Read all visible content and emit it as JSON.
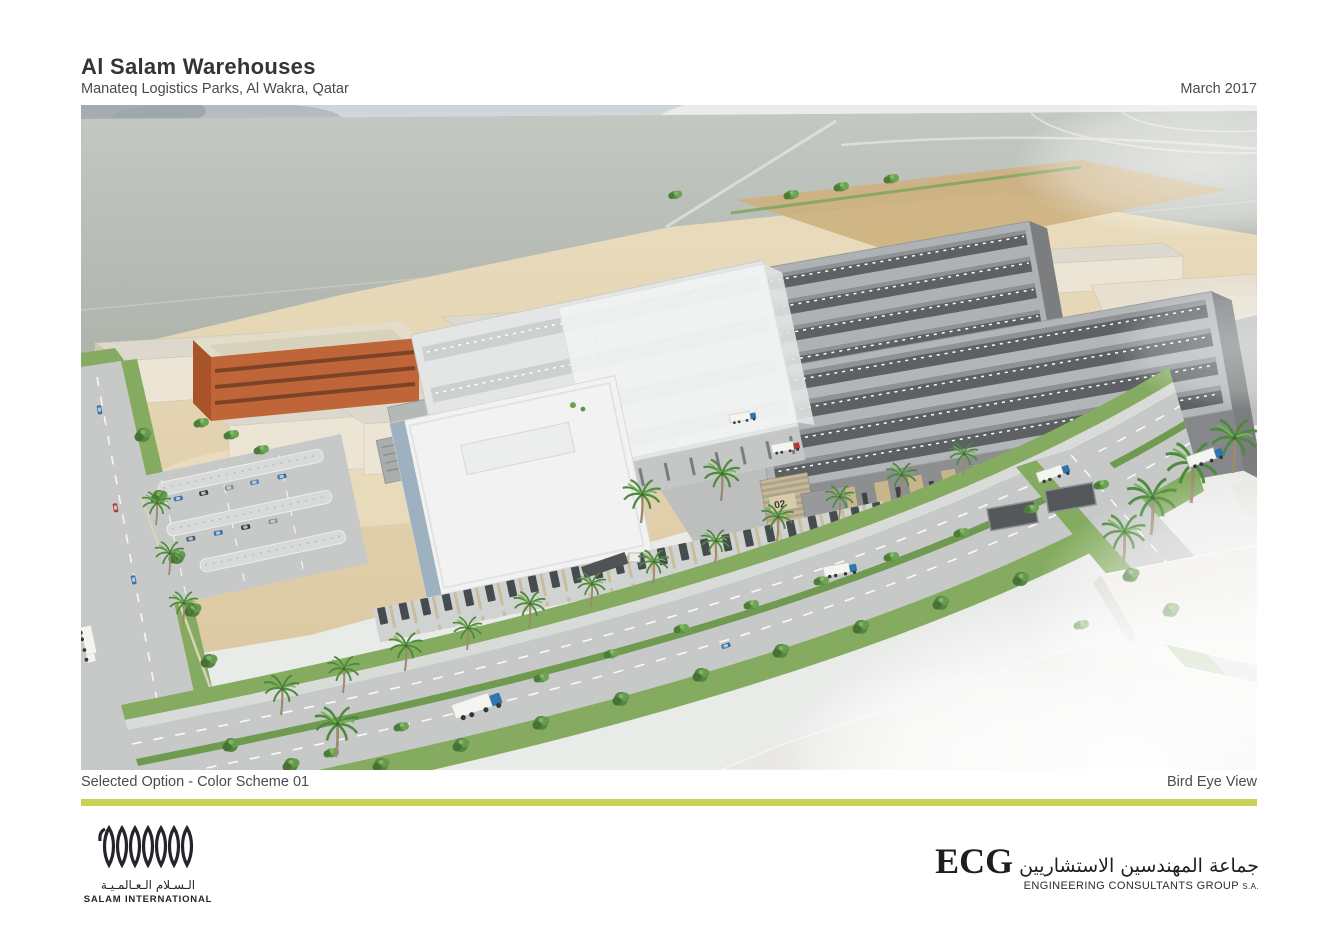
{
  "header": {
    "title": "Al Salam Warehouses",
    "subtitle": "Manateq Logistics Parks, Al Wakra, Qatar",
    "date": "March 2017"
  },
  "footer": {
    "caption_left": "Selected Option - Color Scheme 01",
    "caption_right": "Bird Eye View"
  },
  "scene": {
    "building_01_label": "01",
    "building_02_label": "02",
    "salam_wall_signature": "SALAM"
  },
  "logos": {
    "salam_international": {
      "name_arabic": "الـسـلام الـعـالمـيـة",
      "name_latin": "SALAM INTERNATIONAL"
    },
    "ecg": {
      "acronym": "ECG",
      "name_arabic": "جماعة المهندسين الاستشاريين",
      "name_latin": "ENGINEERING CONSULTANTS GROUP",
      "suffix": "S.A."
    }
  },
  "colors": {
    "accent_bar": "#c7d254",
    "sand": "#e2d2ac",
    "warehouse_grey": "#87898b",
    "landscape_green": "#7da75a",
    "title_text": "#343434"
  }
}
